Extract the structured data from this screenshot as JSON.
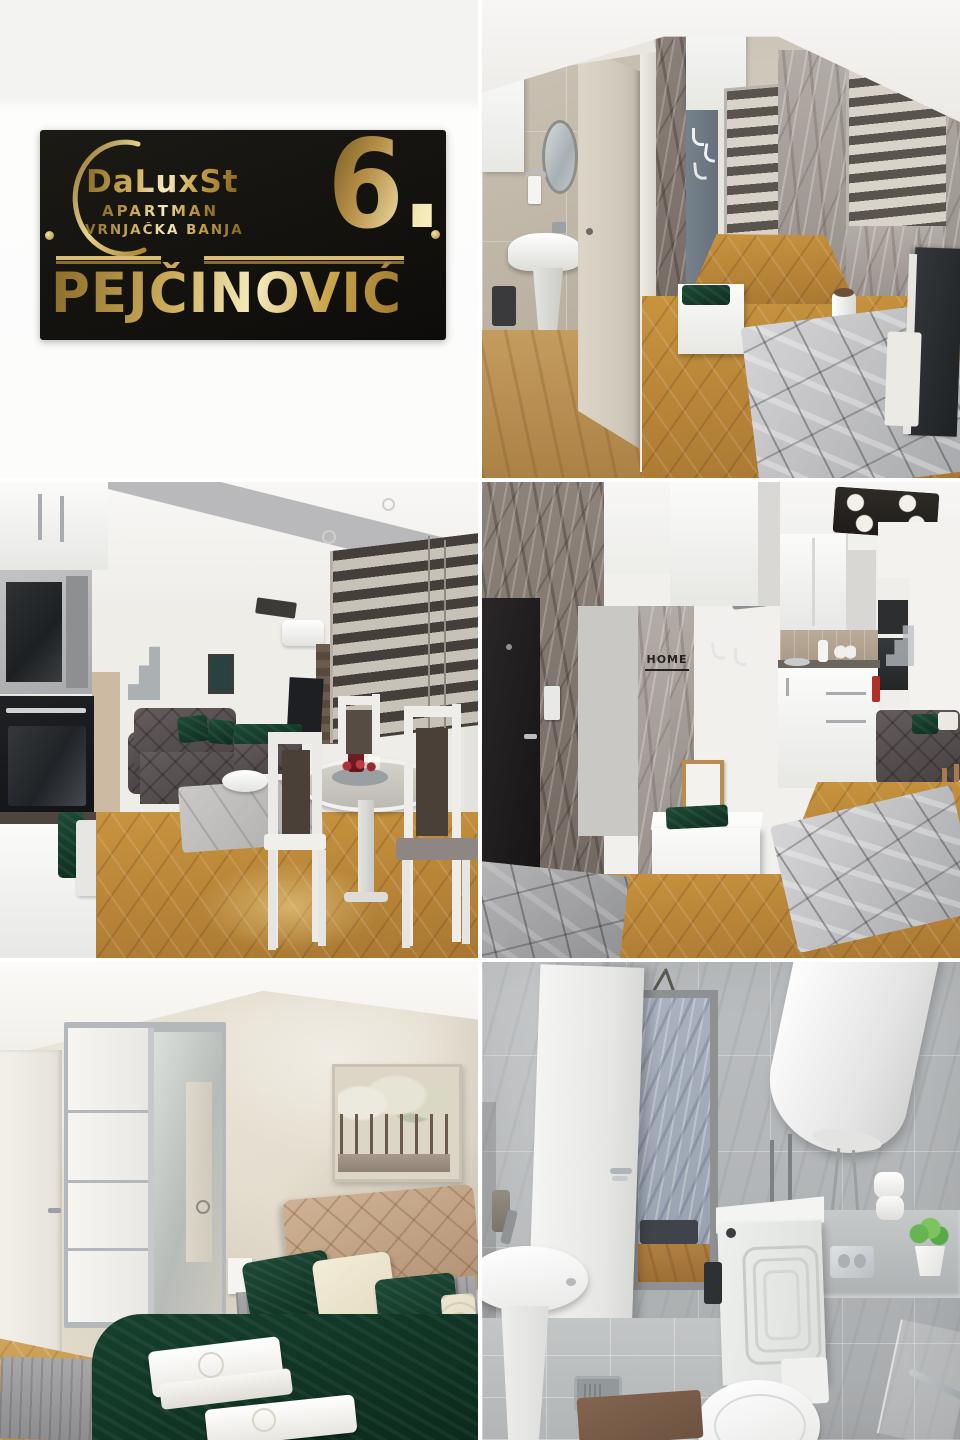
{
  "page": {
    "background": "#ffffff"
  },
  "logo_panel": {
    "panel_bg": "#fbfbfa",
    "card_bg": "#14110d",
    "gold": "#caa64d",
    "gold_light": "#f6ecc0",
    "gold_dark": "#8a6b28",
    "brand": "DaLuxSt",
    "subtitle": "APARTMAN",
    "location": "VRNJAČKA BANJA",
    "number": "6.",
    "family_name": "PEJČINOVIĆ"
  },
  "photos": {
    "kitchen_hall": {
      "home_sign": "HOME"
    }
  }
}
